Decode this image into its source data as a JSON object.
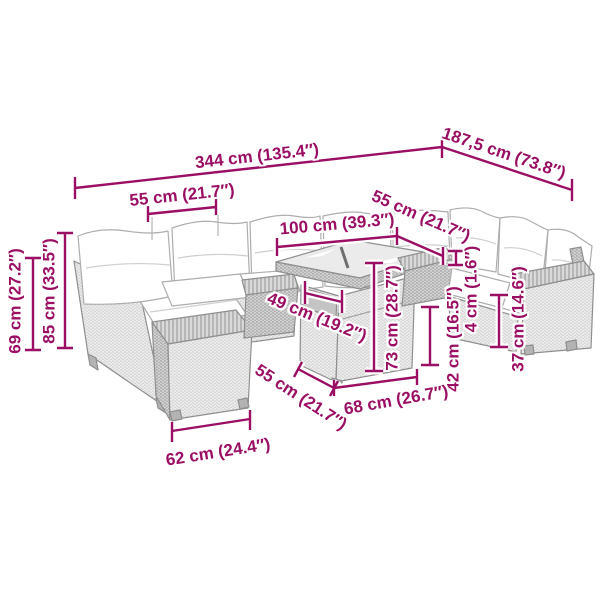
{
  "diagram": {
    "type": "product-dimension-drawing",
    "subject": "modular rattan garden lounge set with glass-top table",
    "units_primary": "cm",
    "units_secondary": "inches"
  },
  "colors": {
    "dimension_accent": "#9A0F63",
    "background": "#FFFFFF",
    "furniture_line": "#8F8F8F"
  },
  "dimensions": {
    "d344": {
      "label": "344 cm (135.4″)",
      "cm": "344",
      "inches": "135.4"
    },
    "d187": {
      "label": "187,5 cm (73.8″)",
      "cm": "187,5",
      "inches": "73.8"
    },
    "d55a": {
      "label": "55 cm (21.7″)",
      "cm": "55",
      "inches": "21.7"
    },
    "d100": {
      "label": "100 cm (39.3″)",
      "cm": "100",
      "inches": "39.3"
    },
    "d55b": {
      "label": "55 cm (21.7″)",
      "cm": "55",
      "inches": "21.7"
    },
    "d49": {
      "label": "49 cm (19.2″)",
      "cm": "49",
      "inches": "19.2"
    },
    "d73": {
      "label": "73 cm (28.7″)",
      "cm": "73",
      "inches": "28.7"
    },
    "d42": {
      "label": "42 cm (16.5″)",
      "cm": "42",
      "inches": "16.5"
    },
    "d4": {
      "label": "4 cm (1.6″)",
      "cm": "4",
      "inches": "1.6"
    },
    "d37": {
      "label": "37 cm (14.6″)",
      "cm": "37",
      "inches": "14.6"
    },
    "d68": {
      "label": "68 cm (26.7″)",
      "cm": "68",
      "inches": "26.7"
    },
    "d55c": {
      "label": "55 cm (21.7″)",
      "cm": "55",
      "inches": "21.7"
    },
    "d62": {
      "label": "62 cm (24.4″)",
      "cm": "62",
      "inches": "24.4"
    },
    "d69": {
      "label": "69 cm (27.2″)",
      "cm": "69",
      "inches": "27.2"
    },
    "d85": {
      "label": "85 cm (33.5″)",
      "cm": "85",
      "inches": "33.5"
    }
  }
}
